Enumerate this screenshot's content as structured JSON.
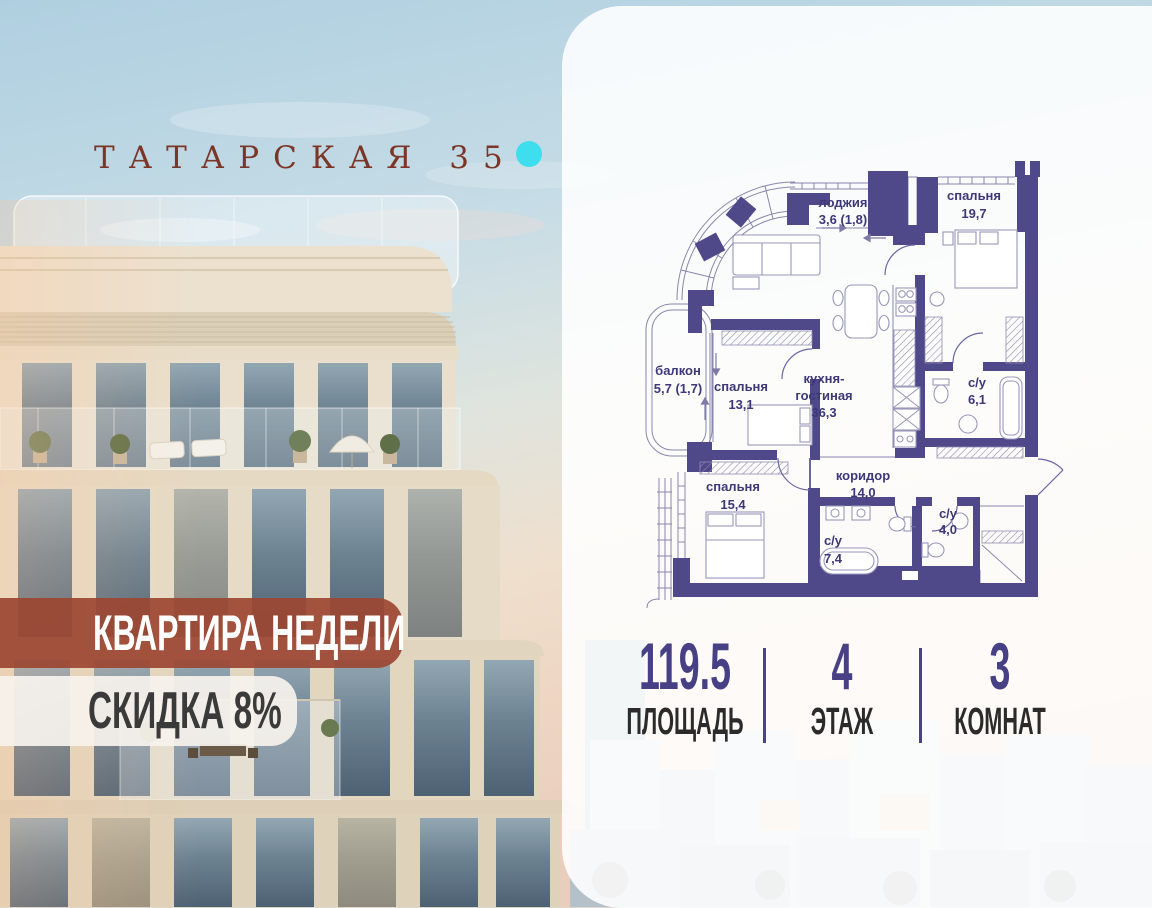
{
  "brand": {
    "name": "ТАТАРСКАЯ 35"
  },
  "badges": {
    "headline": "КВАРТИРА НЕДЕЛИ",
    "offer": "СКИДКА 8%"
  },
  "floor_plan": {
    "rooms": {
      "loggia": {
        "name": "лоджия",
        "area": "3,6 (1,8)"
      },
      "bedroom_top": {
        "name": "спальня",
        "area": "19,7"
      },
      "balcony": {
        "name": "балкон",
        "area": "5,7 (1,7)"
      },
      "bedroom_mid": {
        "name": "спальня",
        "area": "13,1"
      },
      "kitchen_living": {
        "name_line1": "кухня-",
        "name_line2": "гостиная",
        "area": "36,3"
      },
      "bath_ensuite": {
        "name": "с/у",
        "area": "6,1"
      },
      "bedroom_bottom": {
        "name": "спальня",
        "area": "15,4"
      },
      "corridor": {
        "name": "коридор",
        "area": "14,0"
      },
      "bath_main": {
        "name": "с/у",
        "area": "7,4"
      },
      "bath_guest": {
        "name": "с/у",
        "area": "4,0"
      }
    }
  },
  "stats": {
    "area": {
      "value": "119.5",
      "label": "ПЛОЩАДЬ"
    },
    "floor": {
      "value": "4",
      "label": "ЭТАЖ"
    },
    "rooms": {
      "value": "3",
      "label": "КОМНАТ"
    }
  },
  "colors": {
    "accent_dot": "#3fdeee",
    "logo_text": "#7c3627",
    "badge_primary_bg": "#9c4733",
    "badge_primary_text": "#ffffff",
    "badge_secondary_bg": "#f6f2ed",
    "badge_secondary_text": "#3a3a3a",
    "plan_walls": "#4f4889",
    "stat_number": "#474084",
    "stat_label": "#2b2b2b"
  }
}
